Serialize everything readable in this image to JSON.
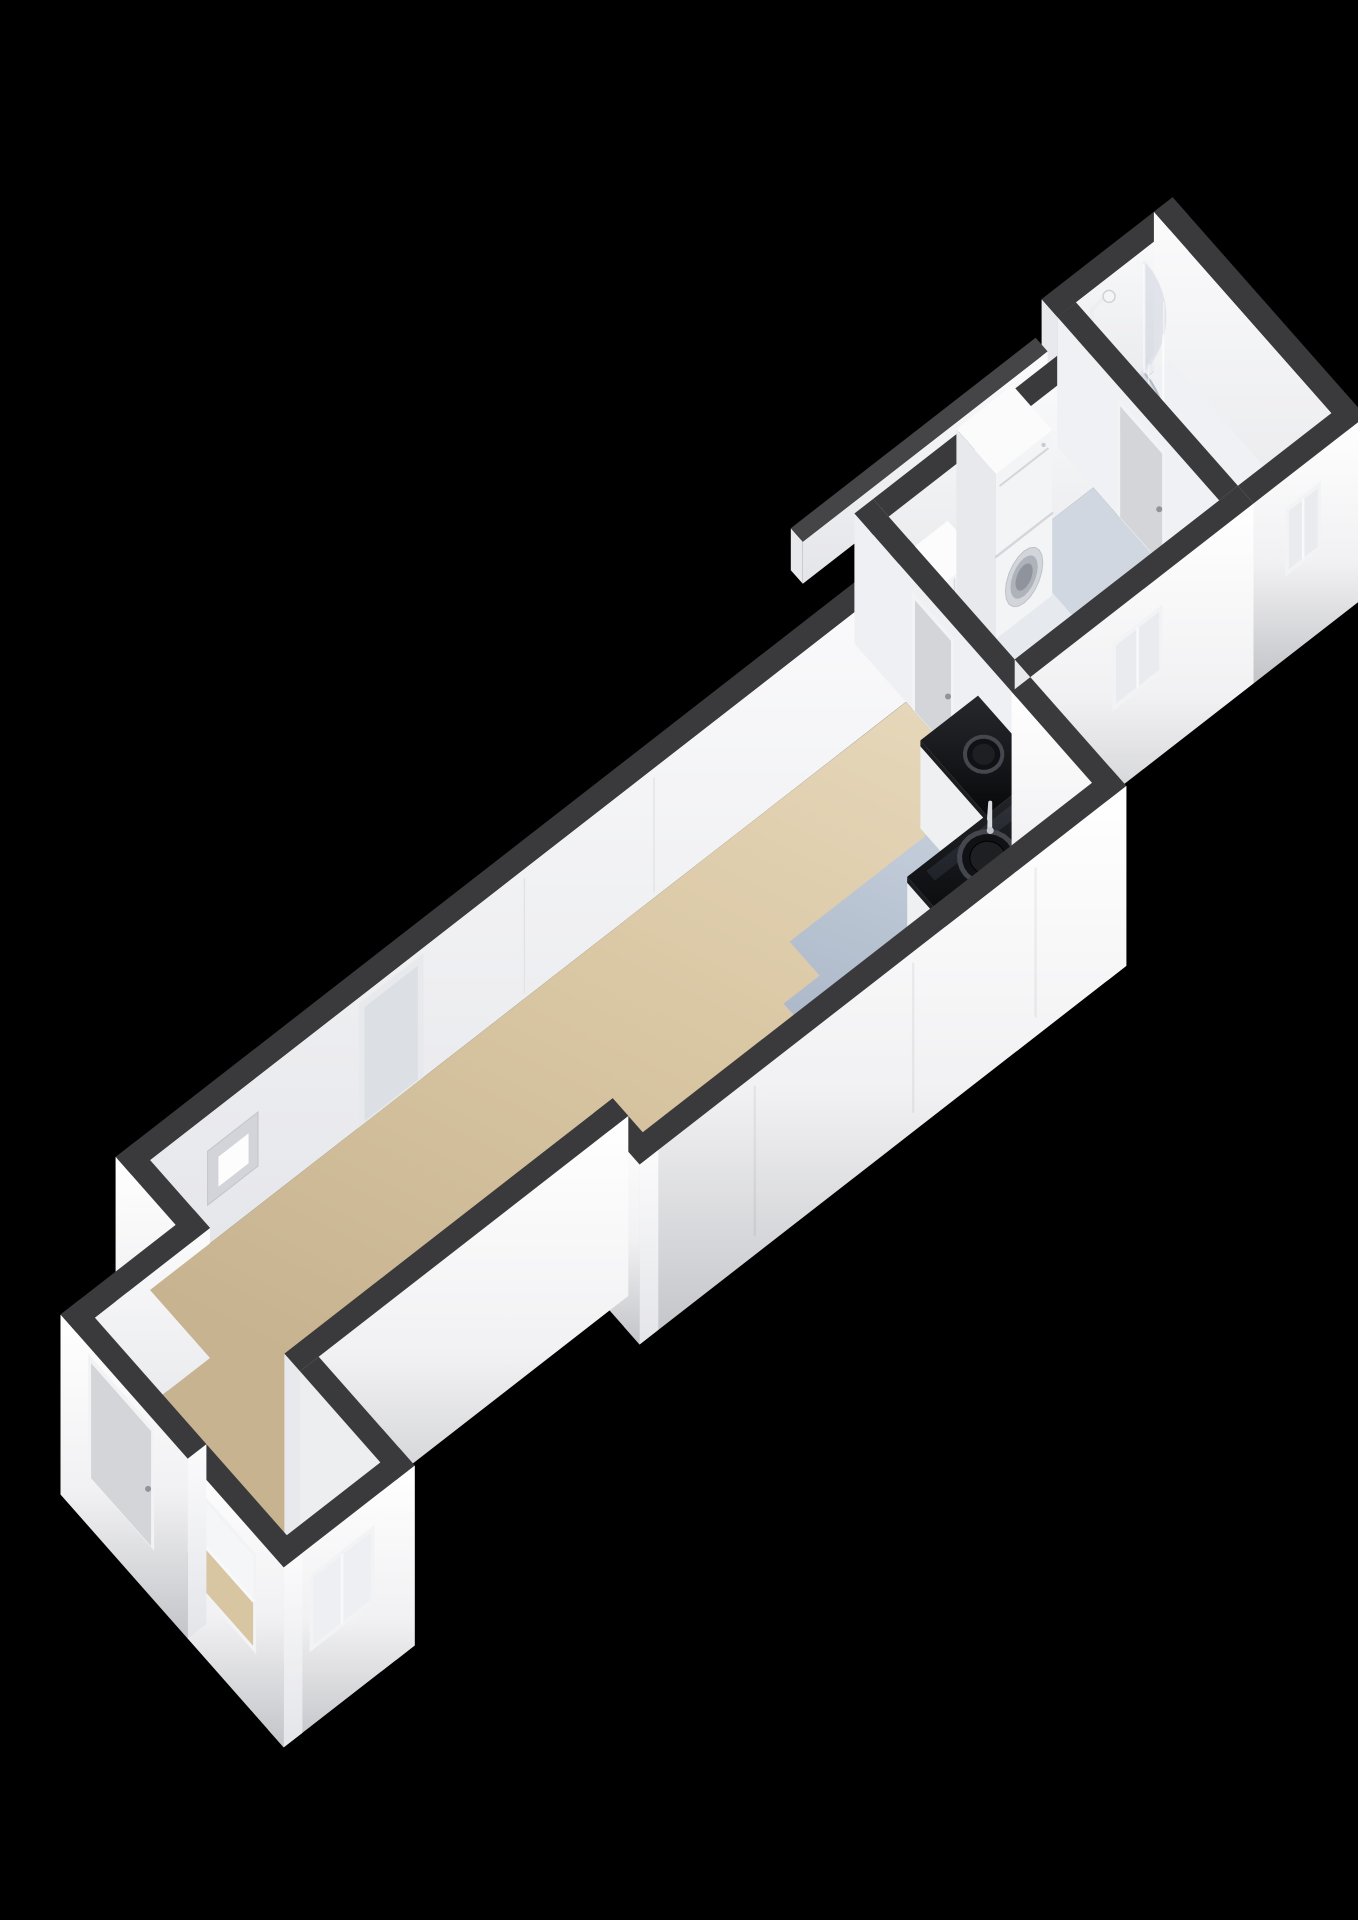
{
  "scene": {
    "type": "3d-floorplan-isometric-view",
    "background": "#000000",
    "floor_shown": "apartment-floor"
  },
  "palette": {
    "wall_cap": "#3a3a3c",
    "wall_cap_light": "#454548",
    "wall_outer_top": "#ffffff",
    "wall_outer_mid": "#f1f1f3",
    "wall_outer_bottom": "#c3c4c8",
    "wall_inner_top": "#fbfbfc",
    "wall_inner_bottom": "#e4e5e9",
    "wall_end_face": "#e8e9ec",
    "floor_living_light": "#e6d7ba",
    "floor_living": "#d8c5a1",
    "floor_living_dark": "#c7b390",
    "floor_kitchen_light": "#c9d2de",
    "floor_kitchen": "#b7c2d1",
    "floor_kitchen_dark": "#a9b6c7",
    "floor_utility": "#e6e9ee",
    "floor_bathroom": "#eff1f4",
    "shower_tray": "#e2e5ea",
    "counter_top_hi": "#26282c",
    "counter_top": "#08090b",
    "counter_base": "#eef0f2",
    "appliance_body": "#f3f4f6",
    "appliance_shade": "#e7e9ec",
    "appliance_detail": "#c9ccd2",
    "door_frame": "#f2f3f5",
    "door_panel": "#d3d5d9",
    "handle_metal": "#8f939a",
    "glass": "#c3cad6",
    "fixture_metal": "#d8dbe0",
    "window_fill": "#e9ebee",
    "accent_red": "#a83232",
    "accent_dark": "#1c1c1e",
    "sink_rim": "#44474d",
    "sink_basin": "#101114",
    "sink_inner": "#1d1f23"
  },
  "components": [
    {
      "name": "entrance-door",
      "kind": "exterior-door"
    },
    {
      "name": "vestibule-wall",
      "kind": "wall"
    },
    {
      "name": "bay-window-front",
      "kind": "window"
    },
    {
      "name": "bay-window-side",
      "kind": "window"
    },
    {
      "name": "living-room-floor",
      "kind": "floor"
    },
    {
      "name": "wall-niche",
      "kind": "recess"
    },
    {
      "name": "intercom-unit",
      "kind": "device"
    },
    {
      "name": "closet-recess-door",
      "kind": "interior-door"
    },
    {
      "name": "living-utility-door",
      "kind": "interior-door"
    },
    {
      "name": "kitchen-floor",
      "kind": "floor"
    },
    {
      "name": "kitchen-counter",
      "kind": "counter"
    },
    {
      "name": "kitchen-sink",
      "kind": "sink"
    },
    {
      "name": "kitchen-second-basin",
      "kind": "sink"
    },
    {
      "name": "kitchen-faucet",
      "kind": "faucet"
    },
    {
      "name": "kitchen-window",
      "kind": "window"
    },
    {
      "name": "utility-floor",
      "kind": "floor"
    },
    {
      "name": "utility-cabinet",
      "kind": "cabinet"
    },
    {
      "name": "washer-dryer-stack",
      "kind": "appliance"
    },
    {
      "name": "utility-window",
      "kind": "window"
    },
    {
      "name": "bathroom-door",
      "kind": "interior-door"
    },
    {
      "name": "bathroom-floor",
      "kind": "floor"
    },
    {
      "name": "shower-enclosure",
      "kind": "shower"
    },
    {
      "name": "shower-head",
      "kind": "fixture"
    },
    {
      "name": "bathroom-window",
      "kind": "window"
    },
    {
      "name": "gallery-ledge",
      "kind": "exterior-structure"
    }
  ]
}
